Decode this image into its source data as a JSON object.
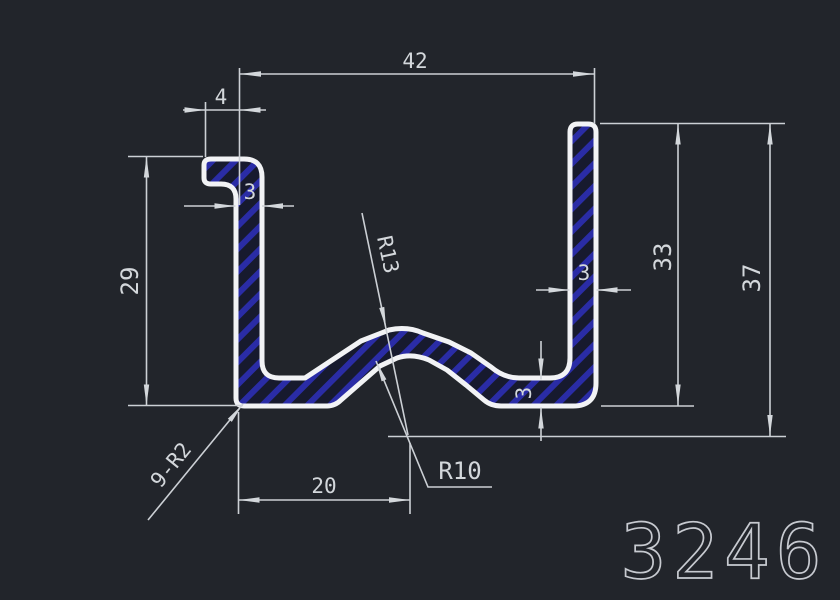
{
  "labels": {
    "overall_width": "42",
    "lip_width": "4",
    "lip_wall_thickness": "3",
    "left_height": "29",
    "right_wall_thickness": "3",
    "right_inner_height": "33",
    "overall_height": "37",
    "bottom_thickness": "3",
    "rib_offset": "20",
    "outer_rib_radius": "R13",
    "inner_rib_radius": "R10",
    "corner_radii": "9-R2",
    "part_number": "3246"
  },
  "colors": {
    "background": "#22252b",
    "profile_outline": "#f2f3f5",
    "hatch_stripe": "#2a2ca6",
    "hatch_base": "#171a2e",
    "dimension_lines": "#ccd0d5",
    "dimension_text": "#d3d7db",
    "part_number_text": "#c7cad0"
  }
}
